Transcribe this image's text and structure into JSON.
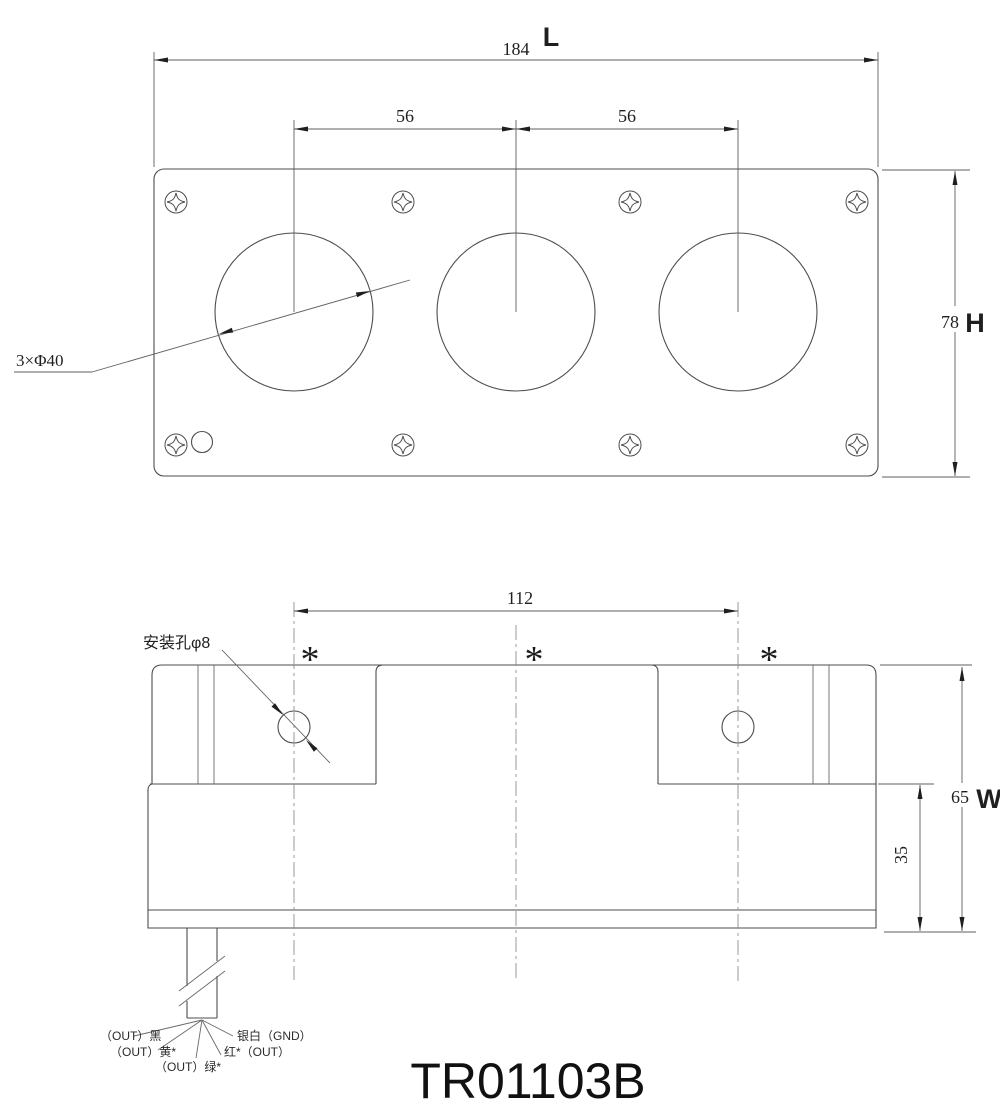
{
  "drawing": {
    "model": "TR01103B",
    "line_color": "#4d4d4d",
    "centerline_color": "#909090",
    "top_view": {
      "dim_length": "184",
      "dim_length_label": "L",
      "dim_spacing_1": "56",
      "dim_spacing_2": "56",
      "dim_height": "78",
      "dim_height_label": "H",
      "hole_callout": "3×Φ40"
    },
    "side_view": {
      "dim_mount_spacing": "112",
      "mount_hole_callout": "安装孔φ8",
      "dim_width": "65",
      "dim_width_label": "W",
      "dim_base_height": "35",
      "asterisk_1": "*",
      "asterisk_2": "*",
      "asterisk_3": "*"
    },
    "wires": {
      "black": "（OUT）黑",
      "yellow": "（OUT）黄*",
      "green": "（OUT）绿*",
      "silver": "银白（GND）",
      "red": "红*（OUT）"
    }
  }
}
